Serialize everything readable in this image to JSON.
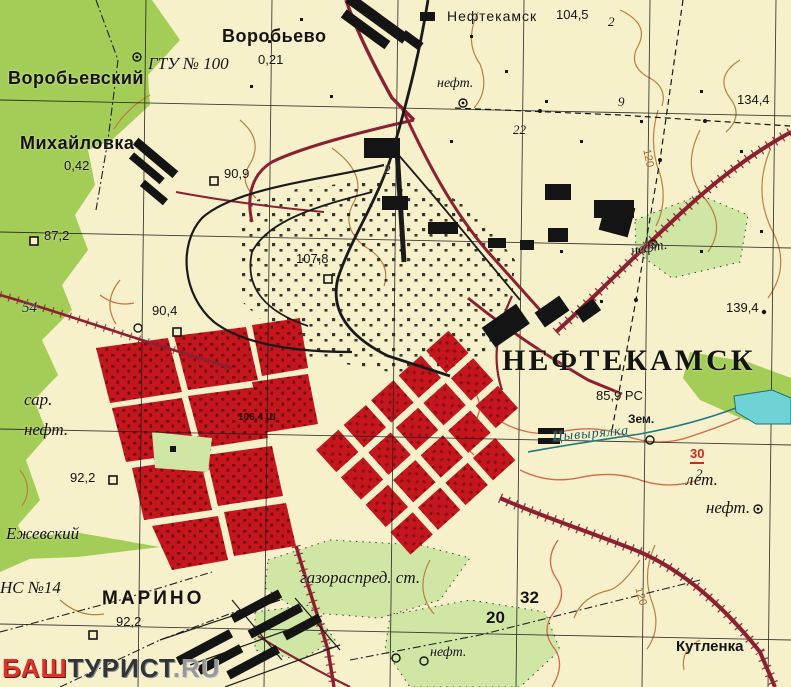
{
  "map": {
    "region_title": "НЕФТЕКАМСК",
    "labels": [
      {
        "name": "settlement-vorobyevsky",
        "text": "Воробьевский",
        "x": 8,
        "y": 68,
        "cls": "settlement"
      },
      {
        "name": "settlement-vorobyevo",
        "text": "Воробьево",
        "x": 222,
        "y": 26,
        "cls": "settlement"
      },
      {
        "name": "elev-vorobyevo",
        "text": "0,21",
        "x": 258,
        "y": 52,
        "cls": "elev"
      },
      {
        "name": "label-gtu-100",
        "text": "ГТУ № 100",
        "x": 148,
        "y": 54,
        "cls": "terrain-lg"
      },
      {
        "name": "station-neftekamsk",
        "text": "Нефтекамск",
        "x": 447,
        "y": 8,
        "cls": "station"
      },
      {
        "name": "elev-104-5",
        "text": "104,5",
        "x": 556,
        "y": 7,
        "cls": "elev"
      },
      {
        "name": "label-neft-top",
        "text": "нефт.",
        "x": 437,
        "y": 76,
        "cls": "terrain"
      },
      {
        "name": "num-22",
        "text": "22",
        "x": 513,
        "y": 122,
        "cls": "num-it"
      },
      {
        "name": "num-2-top",
        "text": "2",
        "x": 608,
        "y": 14,
        "cls": "num-it"
      },
      {
        "name": "num-2-industrial",
        "text": "2",
        "x": 384,
        "y": 162,
        "cls": "num-it"
      },
      {
        "name": "num-9",
        "text": "9",
        "x": 618,
        "y": 94,
        "cls": "num-it"
      },
      {
        "name": "elev-134-4",
        "text": "134,4",
        "x": 737,
        "y": 92,
        "cls": "elev"
      },
      {
        "name": "settlement-mikhaylovka",
        "text": "Михайловка",
        "x": 20,
        "y": 133,
        "cls": "settlement"
      },
      {
        "name": "elev-mikhaylovka",
        "text": "0,42",
        "x": 64,
        "y": 158,
        "cls": "elev"
      },
      {
        "name": "elev-90-9",
        "text": "90,9",
        "x": 224,
        "y": 166,
        "cls": "elev"
      },
      {
        "name": "elev-87-2",
        "text": "87,2",
        "x": 44,
        "y": 228,
        "cls": "elev"
      },
      {
        "name": "elev-107-8",
        "text": "107,8",
        "x": 296,
        "y": 251,
        "cls": "elev"
      },
      {
        "name": "elev-90-4",
        "text": "90,4",
        "x": 152,
        "y": 303,
        "cls": "elev"
      },
      {
        "name": "grid-54",
        "text": "54",
        "x": 22,
        "y": 300,
        "cls": "grid-coord"
      },
      {
        "name": "label-sar",
        "text": "сар.",
        "x": 24,
        "y": 390,
        "cls": "terrain-lg"
      },
      {
        "name": "label-neft-left",
        "text": "нефт.",
        "x": 24,
        "y": 420,
        "cls": "terrain-lg"
      },
      {
        "name": "elev-139-4",
        "text": "139,4",
        "x": 726,
        "y": 300,
        "cls": "elev"
      },
      {
        "name": "city-neftekamsk",
        "text": "НЕФТЕКАМСК",
        "x": 502,
        "y": 344,
        "cls": "city"
      },
      {
        "name": "elev-85-9-rts",
        "text": "85,9 РС",
        "x": 596,
        "y": 388,
        "cls": "elev"
      },
      {
        "name": "label-zem",
        "text": "Зем.",
        "x": 628,
        "y": 412,
        "cls": "note"
      },
      {
        "name": "hydro-tsyvyryalka",
        "text": "Цывырялка",
        "x": 552,
        "y": 430,
        "cls": "hydro",
        "rot": -5
      },
      {
        "name": "label-let",
        "text": "лет.",
        "x": 686,
        "y": 470,
        "cls": "terrain-lg"
      },
      {
        "name": "bridge-load-30",
        "text": "30",
        "x": 690,
        "y": 446,
        "cls": "red-note"
      },
      {
        "name": "num-2-bridge",
        "text": "2",
        "x": 696,
        "y": 466,
        "cls": "num-it"
      },
      {
        "name": "label-neft-ne",
        "text": "нефт.",
        "x": 630,
        "y": 244,
        "cls": "terrain",
        "rot": -10
      },
      {
        "name": "label-neft-right",
        "text": "нефт.",
        "x": 706,
        "y": 498,
        "cls": "terrain-lg"
      },
      {
        "name": "elev-92-2",
        "text": "92,2",
        "x": 70,
        "y": 470,
        "cls": "elev"
      },
      {
        "name": "label-yezhevsky",
        "text": "Ежевский",
        "x": 6,
        "y": 524,
        "cls": "terrain-lg"
      },
      {
        "name": "label-ns-14",
        "text": "НС №14",
        "x": 0,
        "y": 578,
        "cls": "terrain-lg"
      },
      {
        "name": "settlement-marino",
        "text": "МАРИНО",
        "x": 102,
        "y": 588,
        "cls": "settlement-caps"
      },
      {
        "name": "elev-92-2-marino",
        "text": "92,2",
        "x": 116,
        "y": 614,
        "cls": "elev"
      },
      {
        "name": "label-gazoraspred",
        "text": "газораспред. ст.",
        "x": 300,
        "y": 568,
        "cls": "terrain-lg"
      },
      {
        "name": "grid-20",
        "text": "20",
        "x": 486,
        "y": 608,
        "cls": "grid-num"
      },
      {
        "name": "grid-32",
        "text": "32",
        "x": 520,
        "y": 588,
        "cls": "grid-num"
      },
      {
        "name": "label-neft-bottom",
        "text": "нефт.",
        "x": 430,
        "y": 645,
        "cls": "terrain"
      },
      {
        "name": "settlement-kutlenka",
        "text": "Кутленка",
        "x": 676,
        "y": 638,
        "cls": "settlement-sm"
      },
      {
        "name": "note-106-4",
        "text": "106,4 Ш",
        "x": 238,
        "y": 412,
        "cls": "note-dark"
      },
      {
        "name": "contour-120-ne",
        "text": "120",
        "x": 652,
        "y": 148,
        "cls": "contour-num",
        "rot": 78
      },
      {
        "name": "contour-120-se",
        "text": "120",
        "x": 644,
        "y": 586,
        "cls": "contour-num",
        "rot": 75
      }
    ]
  },
  "watermark": {
    "part1": "БАШ",
    "part2": "ТУРИСТ",
    "part3": ".RU"
  },
  "colors": {
    "paper": "#f7f1cb",
    "forest": "#a4cd58",
    "scrub": "#cfe6a4",
    "urban_blocks": "#c5161d",
    "major_road": "#8a2030",
    "railway": "#1a1a1a",
    "contour": "#b97f3f",
    "water": "#6fd2d4",
    "hydro_text": "#0e5a64",
    "warning_red": "#cc2a1e"
  }
}
